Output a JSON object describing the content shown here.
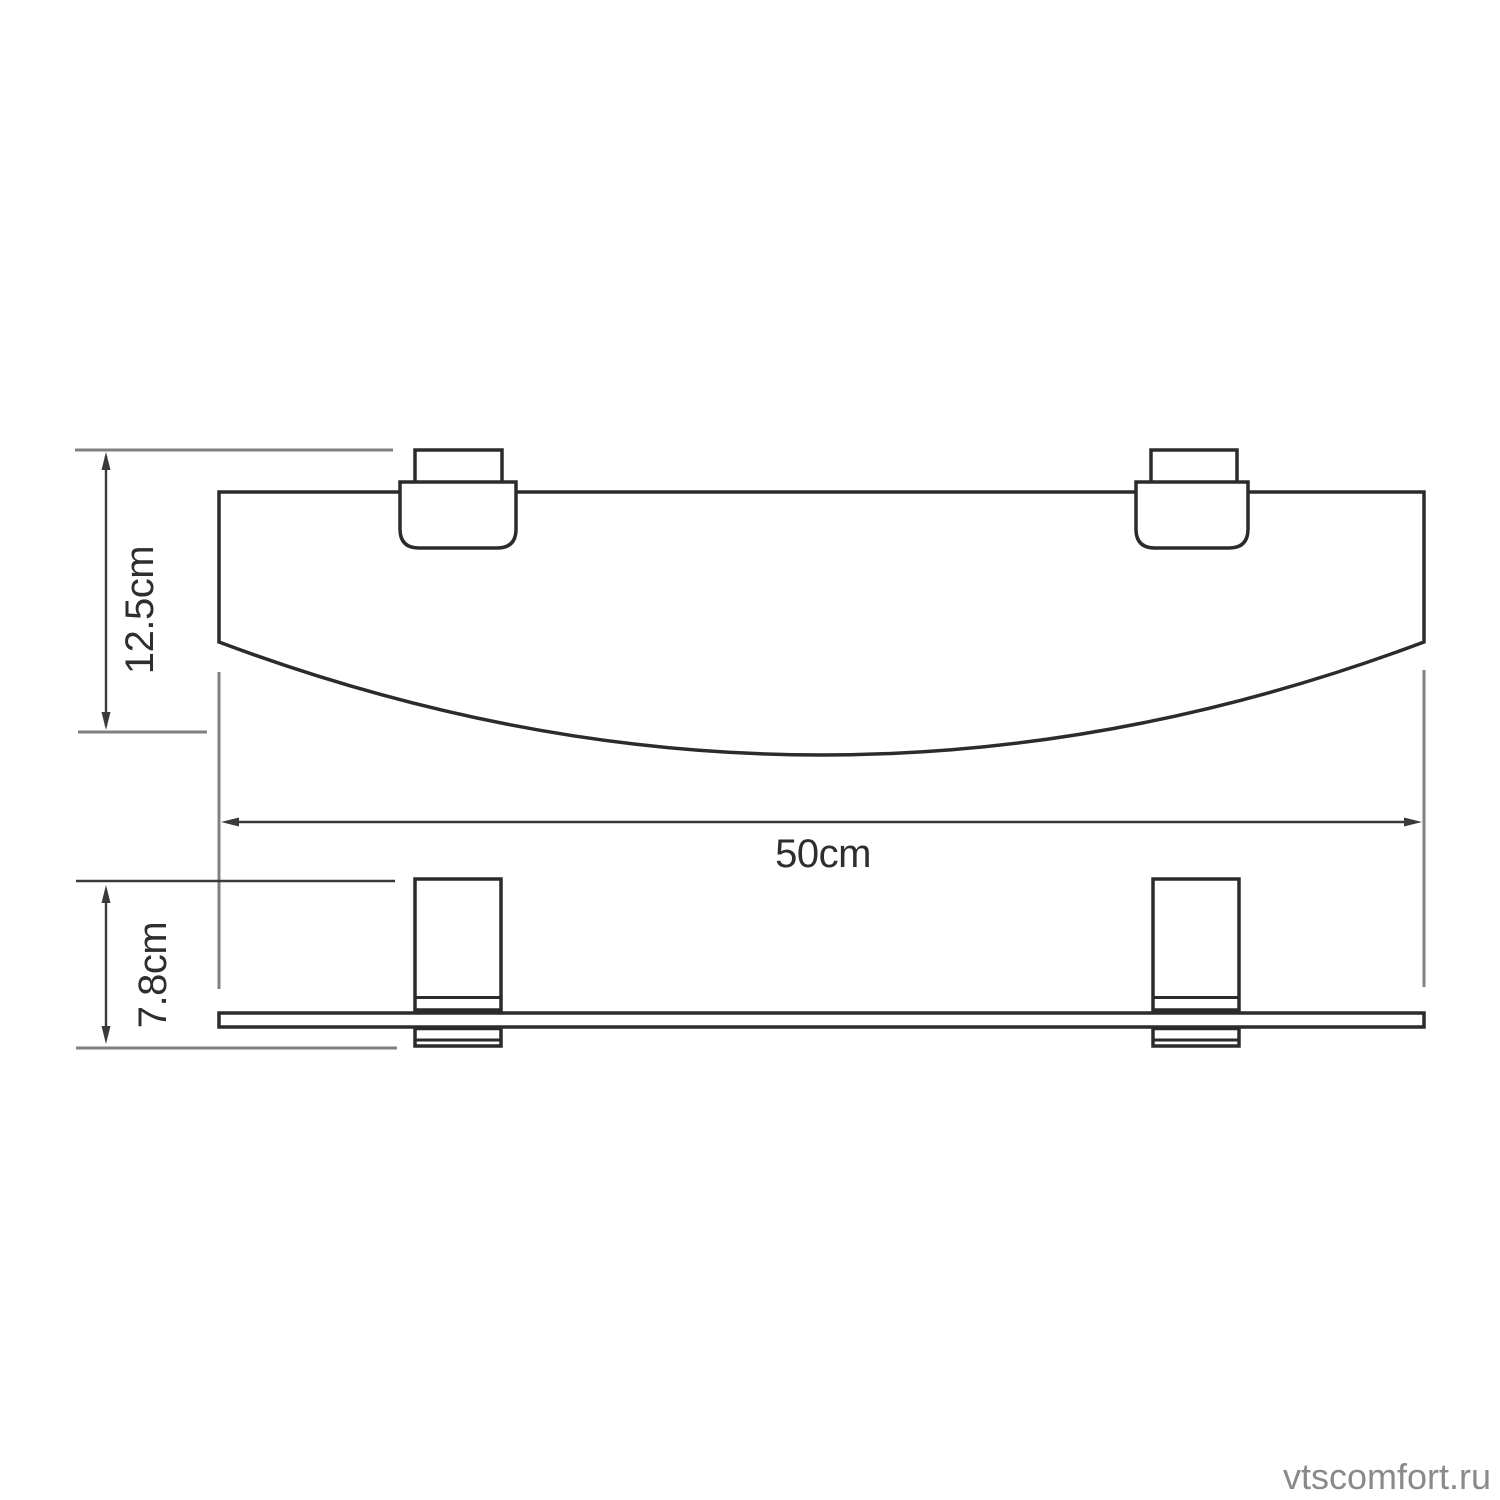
{
  "colors": {
    "background": "#ffffff",
    "fill": "#ffffff",
    "outline": "#2b2b2b",
    "dimension": "#3a3a3a",
    "extension": "#808080",
    "label": "#2e2e2e",
    "watermark": "#8a8a8a"
  },
  "dimensions": {
    "depth": {
      "label": "12.5cm"
    },
    "width": {
      "label": "50cm"
    },
    "height": {
      "label": "7.8cm"
    }
  },
  "watermark": {
    "text": "vtscomfort.ru"
  }
}
